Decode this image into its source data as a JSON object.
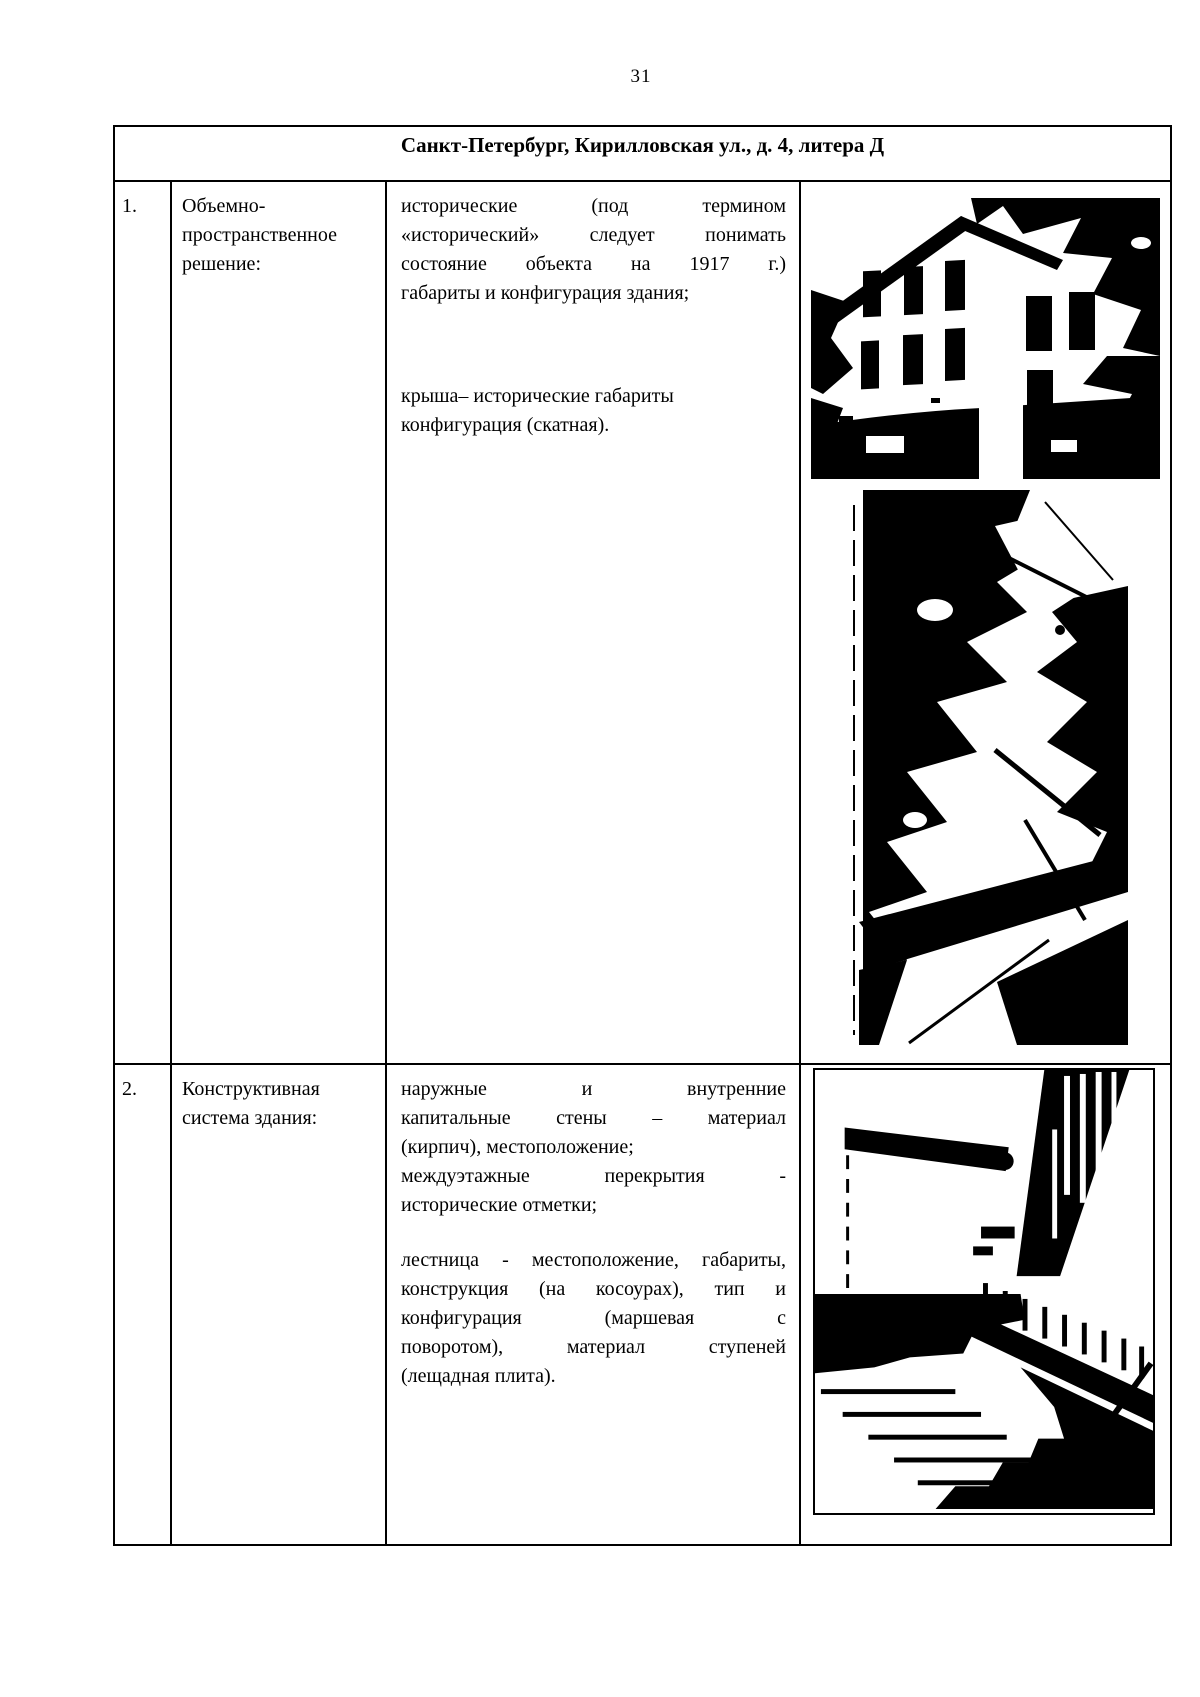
{
  "page_number": "31",
  "table": {
    "header_title": "Санкт-Петербург, Кирилловская ул., д. 4, литера Д",
    "rows": [
      {
        "num": "1.",
        "label_lines": [
          "Объемно-",
          "пространственное",
          "решение:"
        ],
        "paragraphs": [
          {
            "lines": [
              "исторические (под термином",
              "«исторический» следует понимать",
              "состояние объекта на 1917 г.)",
              "габариты и конфигурация здания;"
            ]
          },
          {
            "lines": [
              "крыша– исторические габариты",
              "конфигурация (скатная)."
            ]
          }
        ],
        "photos": [
          "building-facade-photo",
          "courtyard-foliage-photo"
        ]
      },
      {
        "num": "2.",
        "label_lines": [
          "Конструктивная",
          "система здания:"
        ],
        "paragraphs": [
          {
            "lines": [
              "наружные и внутренние",
              "капитальные стены – материал",
              "(кирпич), местоположение;"
            ]
          },
          {
            "lines": [
              "междуэтажные перекрытия -",
              "исторические отметки;"
            ]
          },
          {
            "lines": [
              "лестница - местоположение, габариты,",
              "конструкция (на косоурах), тип и",
              "конфигурация (маршевая с",
              "поворотом), материал ступеней",
              "(лещадная плита)."
            ]
          }
        ],
        "photos": [
          "staircase-photo"
        ]
      }
    ]
  },
  "colors": {
    "ink": "#000000",
    "paper": "#ffffff"
  }
}
